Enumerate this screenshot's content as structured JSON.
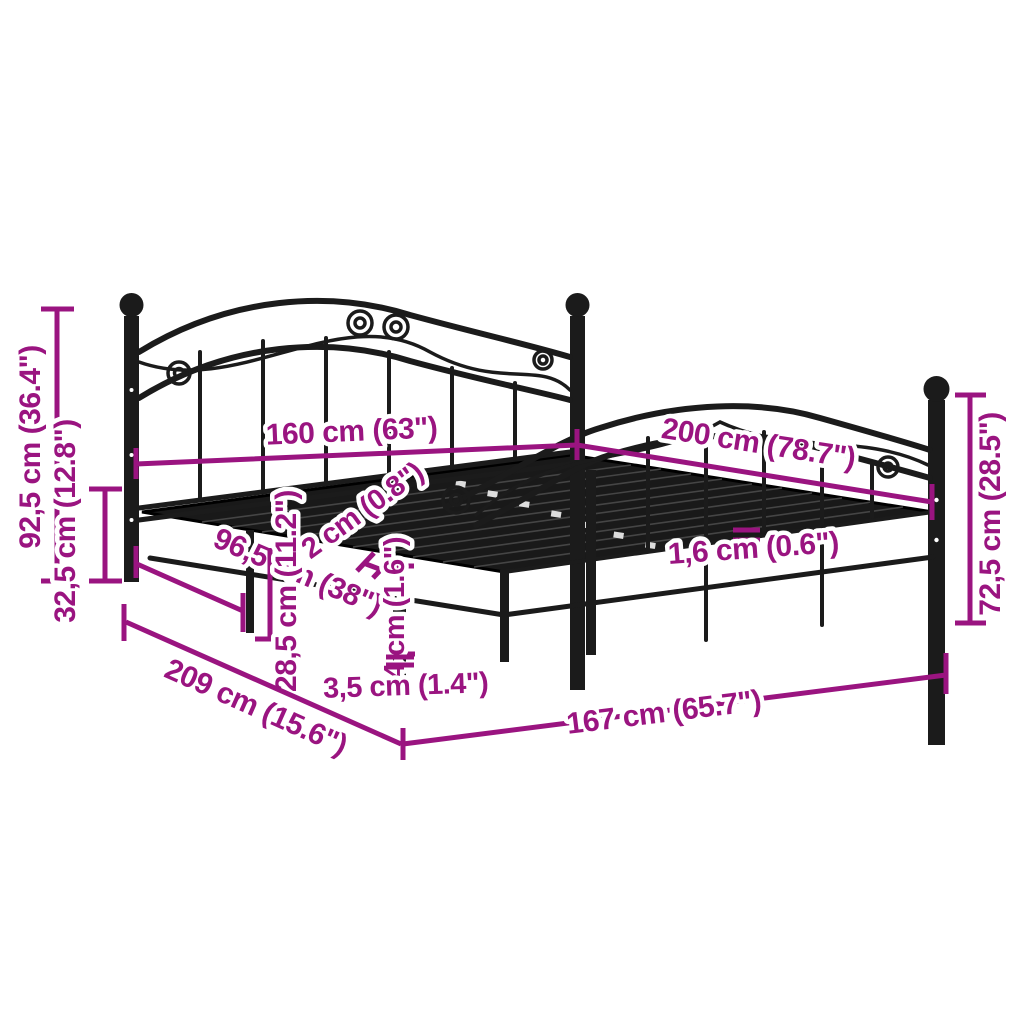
{
  "diagram": {
    "type": "product-dimension-diagram",
    "subject": "black metal bed frame with decorative headboard and footboard",
    "colors": {
      "dimension_accent": "#9a1480",
      "frame": "#1b1b1b",
      "background": "#ffffff",
      "label_halo": "#ffffff"
    }
  },
  "dims": {
    "left_outer_vertical": "92,5 cm (36.4\")",
    "left_inner_vertical": "32,5 cm (12.8\")",
    "left_diagonal": "96,5 cm (38\")",
    "headboard_width": "160 cm (63\")",
    "side_length": "200 cm (78.7\")",
    "slat_thickness": "2 cm (0.8\")",
    "rail_height": "4 cm (1.6\")",
    "under_bed_clearance": "28,5 cm (11.2\")",
    "slat_gap": "1,6 cm (0.6\")",
    "footboard_height": "72,5 cm (28.5\")",
    "bottom_left_diagonal": "209 cm (15.6\")",
    "leg_width": "3,5 cm (1.4\")",
    "bottom_right_diagonal": "167 cm (65.7\")"
  }
}
